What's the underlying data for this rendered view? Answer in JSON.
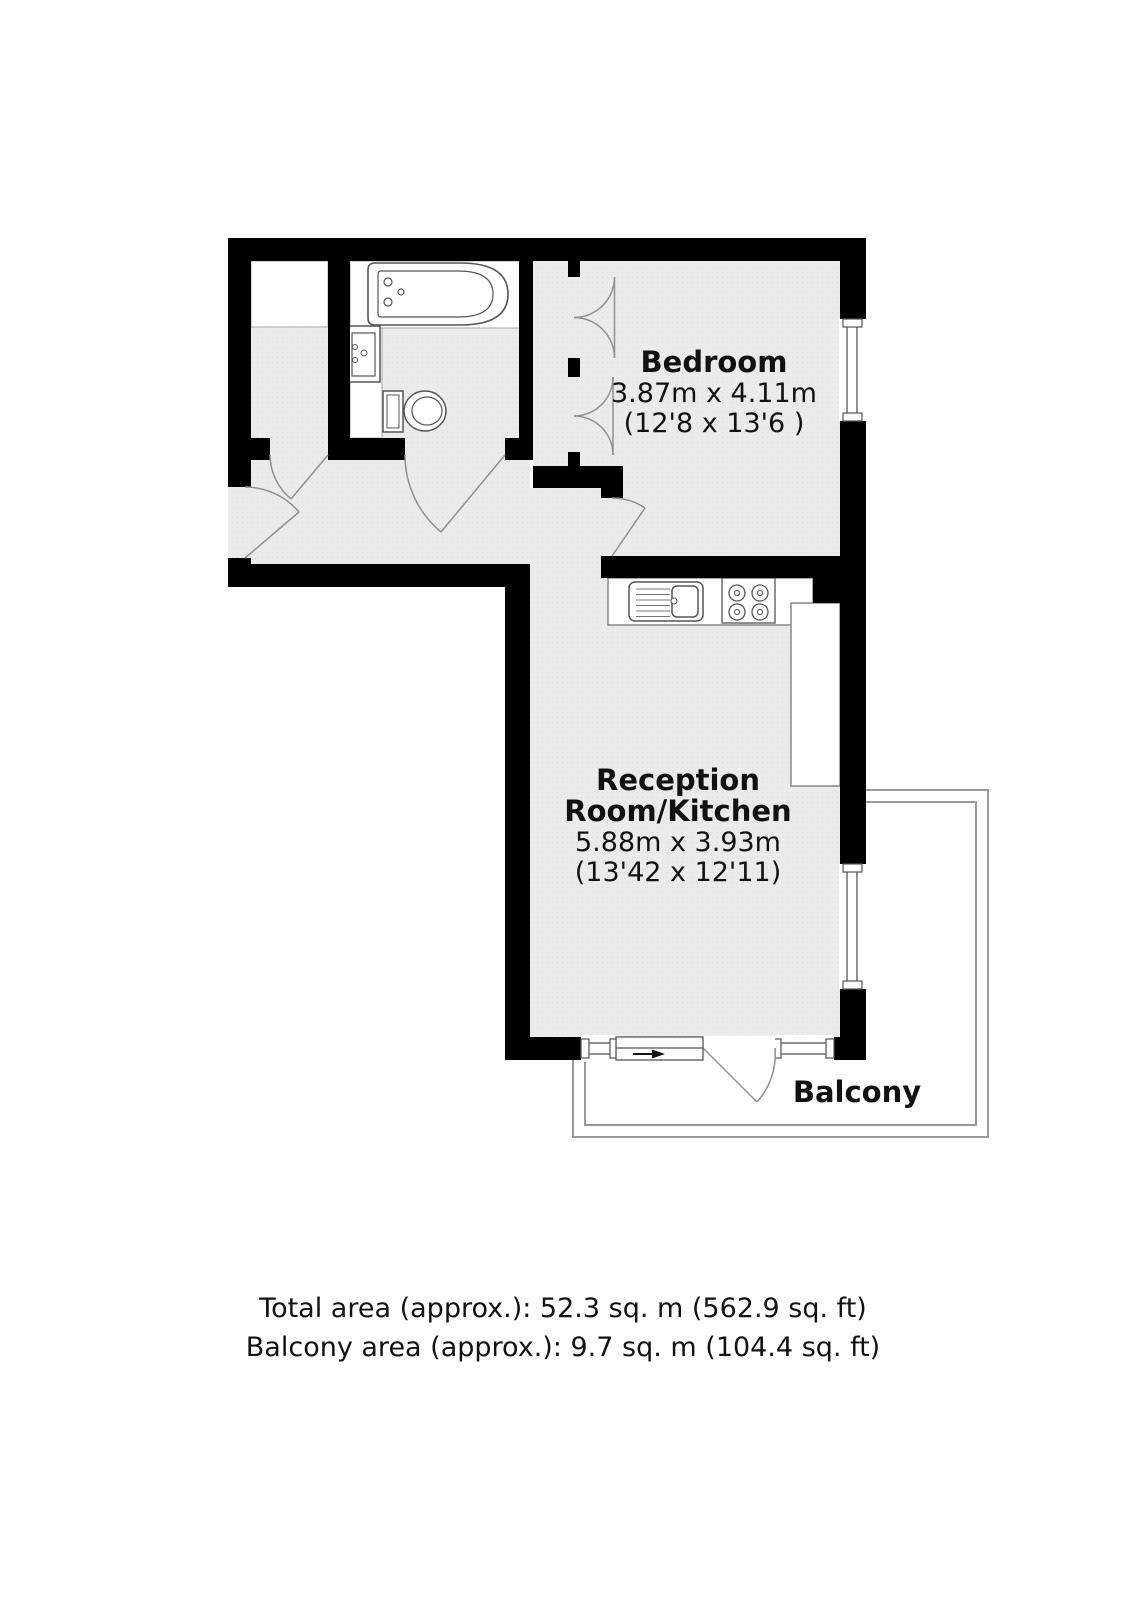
{
  "plan": {
    "bedroom": {
      "name": "Bedroom",
      "size_metric": "3.87m x 4.11m",
      "size_imperial": "(12'8 x 13'6 )"
    },
    "reception": {
      "name_line1": "Reception",
      "name_line2": "Room/Kitchen",
      "size_metric": "5.88m x 3.93m",
      "size_imperial": "(13'42 x 12'11)"
    },
    "balcony": {
      "name": "Balcony"
    },
    "fixtures": [
      "bathtub",
      "wash-basin",
      "toilet",
      "kitchen-sink",
      "hob",
      "kitchen-counter"
    ],
    "colors": {
      "wall": "#000000",
      "floor": "#ebebeb",
      "fixture_outline": "#555555",
      "door_arc": "#909090",
      "balcony_outline": "#999999",
      "background": "#ffffff",
      "text": "#111111"
    }
  },
  "footer": {
    "total_area": "Total area (approx.): 52.3 sq. m (562.9 sq. ft)",
    "balcony_area": "Balcony area (approx.): 9.7 sq. m (104.4 sq. ft)"
  }
}
